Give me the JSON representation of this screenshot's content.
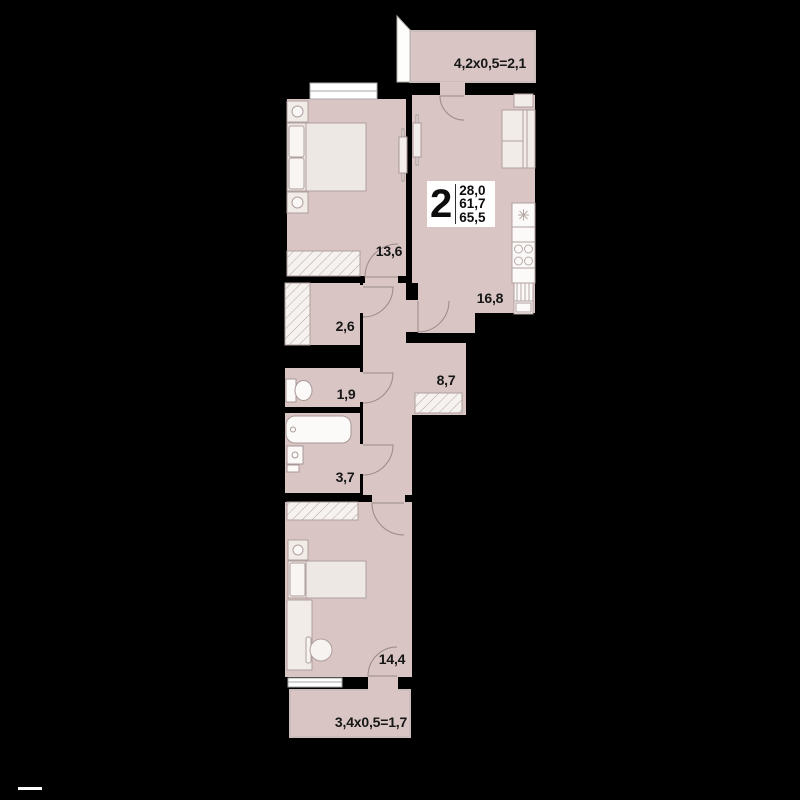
{
  "plan": {
    "badge": {
      "rooms": "2",
      "areas": [
        "28,0",
        "61,7",
        "65,5"
      ]
    },
    "rooms": [
      {
        "name": "bedroom",
        "area": "13,6"
      },
      {
        "name": "kitchen-living",
        "area": "16,8"
      },
      {
        "name": "closet",
        "area": "2,6"
      },
      {
        "name": "wc",
        "area": "1,9"
      },
      {
        "name": "corridor",
        "area": "8,7"
      },
      {
        "name": "bathroom",
        "area": "3,7"
      },
      {
        "name": "bedroom-2",
        "area": "14,4"
      }
    ],
    "balconies": [
      {
        "name": "balcony-top",
        "label": "4,2x0,5=2,1"
      },
      {
        "name": "balcony-bottom",
        "label": "3,4x0,5=1,7"
      }
    ],
    "colors": {
      "background": "#000000",
      "floor": "#d8c5c4",
      "furniture": "#f2ece9",
      "fixture": "#fbfaf9",
      "outline": "#a99997",
      "text": "#161616"
    }
  }
}
